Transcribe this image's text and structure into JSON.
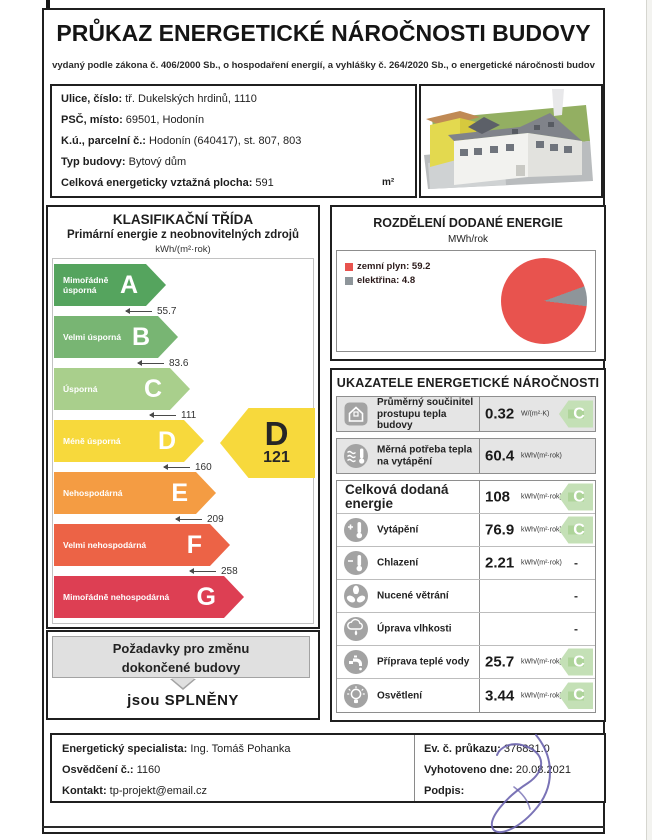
{
  "document": {
    "title": "PRŮKAZ ENERGETICKÉ NÁROČNOSTI BUDOVY",
    "subtitle": "vydaný podle zákona č. 406/2000 Sb., o hospodaření energií, a vyhlášky č. 264/2020 Sb., o energetické náročnosti budov"
  },
  "building_info": {
    "rows": [
      {
        "label": "Ulice, číslo:",
        "value": "tř. Dukelských hrdinů, 1110"
      },
      {
        "label": "PSČ, místo:",
        "value": "69501, Hodonín"
      },
      {
        "label": "K.ú., parcelní č.:",
        "value": "Hodonín (640417), st. 807, 803"
      },
      {
        "label": "Typ budovy:",
        "value": "Bytový dům"
      },
      {
        "label": "Celková energeticky vztažná plocha:",
        "value": "591",
        "unit": "m²"
      }
    ]
  },
  "classification": {
    "title": "KLASIFIKAČNÍ TŘÍDA",
    "subtitle": "Primární energie z neobnovitelných zdrojů",
    "unit": "kWh/(m²·rok)",
    "classes": [
      {
        "letter": "A",
        "label": "Mimořádně úsporná",
        "threshold": "55.7",
        "color": "#55a45e"
      },
      {
        "letter": "B",
        "label": "Velmi úsporná",
        "threshold": "83.6",
        "color": "#78b573"
      },
      {
        "letter": "C",
        "label": "Úsporná",
        "threshold": "111",
        "color": "#a9cf8c"
      },
      {
        "letter": "D",
        "label": "Méně úsporná",
        "threshold": "160",
        "color": "#f7d93c"
      },
      {
        "letter": "E",
        "label": "Nehospodárná",
        "threshold": "209",
        "color": "#f49c43"
      },
      {
        "letter": "F",
        "label": "Velmi nehospodárná",
        "threshold": "258",
        "color": "#ec6346"
      },
      {
        "letter": "G",
        "label": "Mimořádně nehospodárná",
        "threshold": "",
        "color": "#dd3f53"
      }
    ],
    "rating": {
      "letter": "D",
      "value": "121",
      "color": "#f7d93c"
    },
    "requirements": {
      "heading_line1": "Požadavky pro změnu",
      "heading_line2": "dokončené budovy",
      "result": "jsou SPLNĚNY"
    }
  },
  "chart_data": {
    "type": "pie",
    "title": "ROZDĚLENÍ DODANÉ ENERGIE",
    "unit": "MWh/rok",
    "labels": [
      "zemní plyn",
      "elektřina"
    ],
    "values": [
      59.2,
      4.8
    ],
    "colors": [
      "#e8534e",
      "#8e959a"
    ],
    "legend_position": "top-left"
  },
  "indicators": {
    "title": "UKAZATELE ENERGETICKÉ NÁROČNOSTI",
    "badge_color": "#aed49a",
    "rows": [
      {
        "icon": "house-icon",
        "label": "Průměrný součinitel prostupu tepla budovy",
        "value": "0.32",
        "unit": "W/(m²·K)",
        "badge": "C"
      },
      {
        "icon": "heat-demand-icon",
        "label": "Měrná potřeba tepla na vytápění",
        "value": "60.4",
        "unit": "kWh/(m²·rok)",
        "badge": ""
      },
      {
        "icon": "",
        "label": "Celková dodaná energie",
        "value": "108",
        "unit": "kWh/(m²·rok)",
        "badge": "C"
      },
      {
        "icon": "heating-icon",
        "label": "Vytápění",
        "value": "76.9",
        "unit": "kWh/(m²·rok)",
        "badge": "C"
      },
      {
        "icon": "cooling-icon",
        "label": "Chlazení",
        "value": "2.21",
        "unit": "kWh/(m²·rok)",
        "badge": "-"
      },
      {
        "icon": "ventilation-icon",
        "label": "Nucené větrání",
        "value": "",
        "unit": "",
        "badge": "-"
      },
      {
        "icon": "humidity-icon",
        "label": "Úprava vlhkosti",
        "value": "",
        "unit": "",
        "badge": "-"
      },
      {
        "icon": "hot-water-icon",
        "label": "Příprava teplé vody",
        "value": "25.7",
        "unit": "kWh/(m²·rok)",
        "badge": "C"
      },
      {
        "icon": "lighting-icon",
        "label": "Osvětlení",
        "value": "3.44",
        "unit": "kWh/(m²·rok)",
        "badge": "C"
      }
    ]
  },
  "footer": {
    "left": [
      {
        "label": "Energetický specialista:",
        "value": "Ing. Tomáš Pohanka"
      },
      {
        "label": "Osvědčení č.:",
        "value": "1160"
      },
      {
        "label": "Kontakt:",
        "value": "tp-projekt@email.cz"
      }
    ],
    "right": [
      {
        "label": "Ev. č. průkazu:",
        "value": "376831.0"
      },
      {
        "label": "Vyhotoveno dne:",
        "value": "20.08.2021"
      },
      {
        "label": "Podpis:",
        "value": ""
      }
    ]
  }
}
